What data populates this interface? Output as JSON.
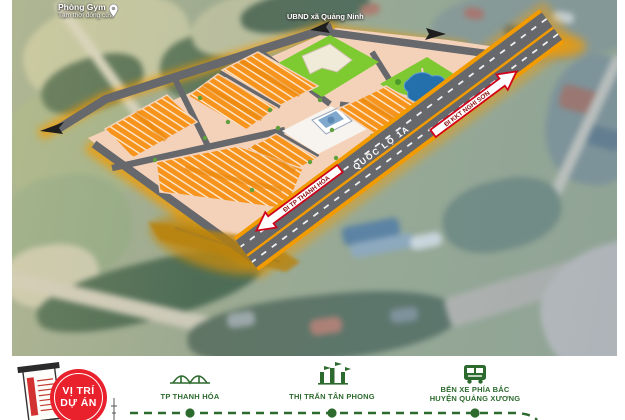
{
  "map": {
    "poi_labels": {
      "gym": {
        "name": "Phòng Gym",
        "status": "Tạm thời đóng cửa"
      },
      "ubnd": {
        "name": "UBND xã Quảng Ninh"
      }
    },
    "road_label": "QUỐC LỘ 1A",
    "direction_signs": {
      "southwest": {
        "label": "ĐI TP THANH HÓA"
      },
      "northeast": {
        "label": "ĐI KKT NGHI SƠN"
      }
    }
  },
  "legend": {
    "badge": {
      "line1": "VỊ TRÍ",
      "line2": "DỰ ÁN"
    },
    "items": [
      {
        "icon": "bridge-icon",
        "label": "TP THANH HÓA"
      },
      {
        "icon": "gate-icon",
        "label": "THỊ TRẤN TÂN PHONG"
      },
      {
        "icon": "bus-icon",
        "label_line1": "BẾN XE PHÍA BẮC",
        "label_line2": "HUYỆN QUẢNG XƯƠNG"
      }
    ]
  },
  "colors": {
    "block_orange": "#f7941e",
    "highway_stripe": "#f29b00",
    "road_gray": "#66686c",
    "site_cream": "#f4d2ba",
    "park_green": "#7ec832",
    "pond_blue": "#2470ad",
    "legend_green": "#2d6a2e",
    "badge_red": "#e8212d"
  }
}
